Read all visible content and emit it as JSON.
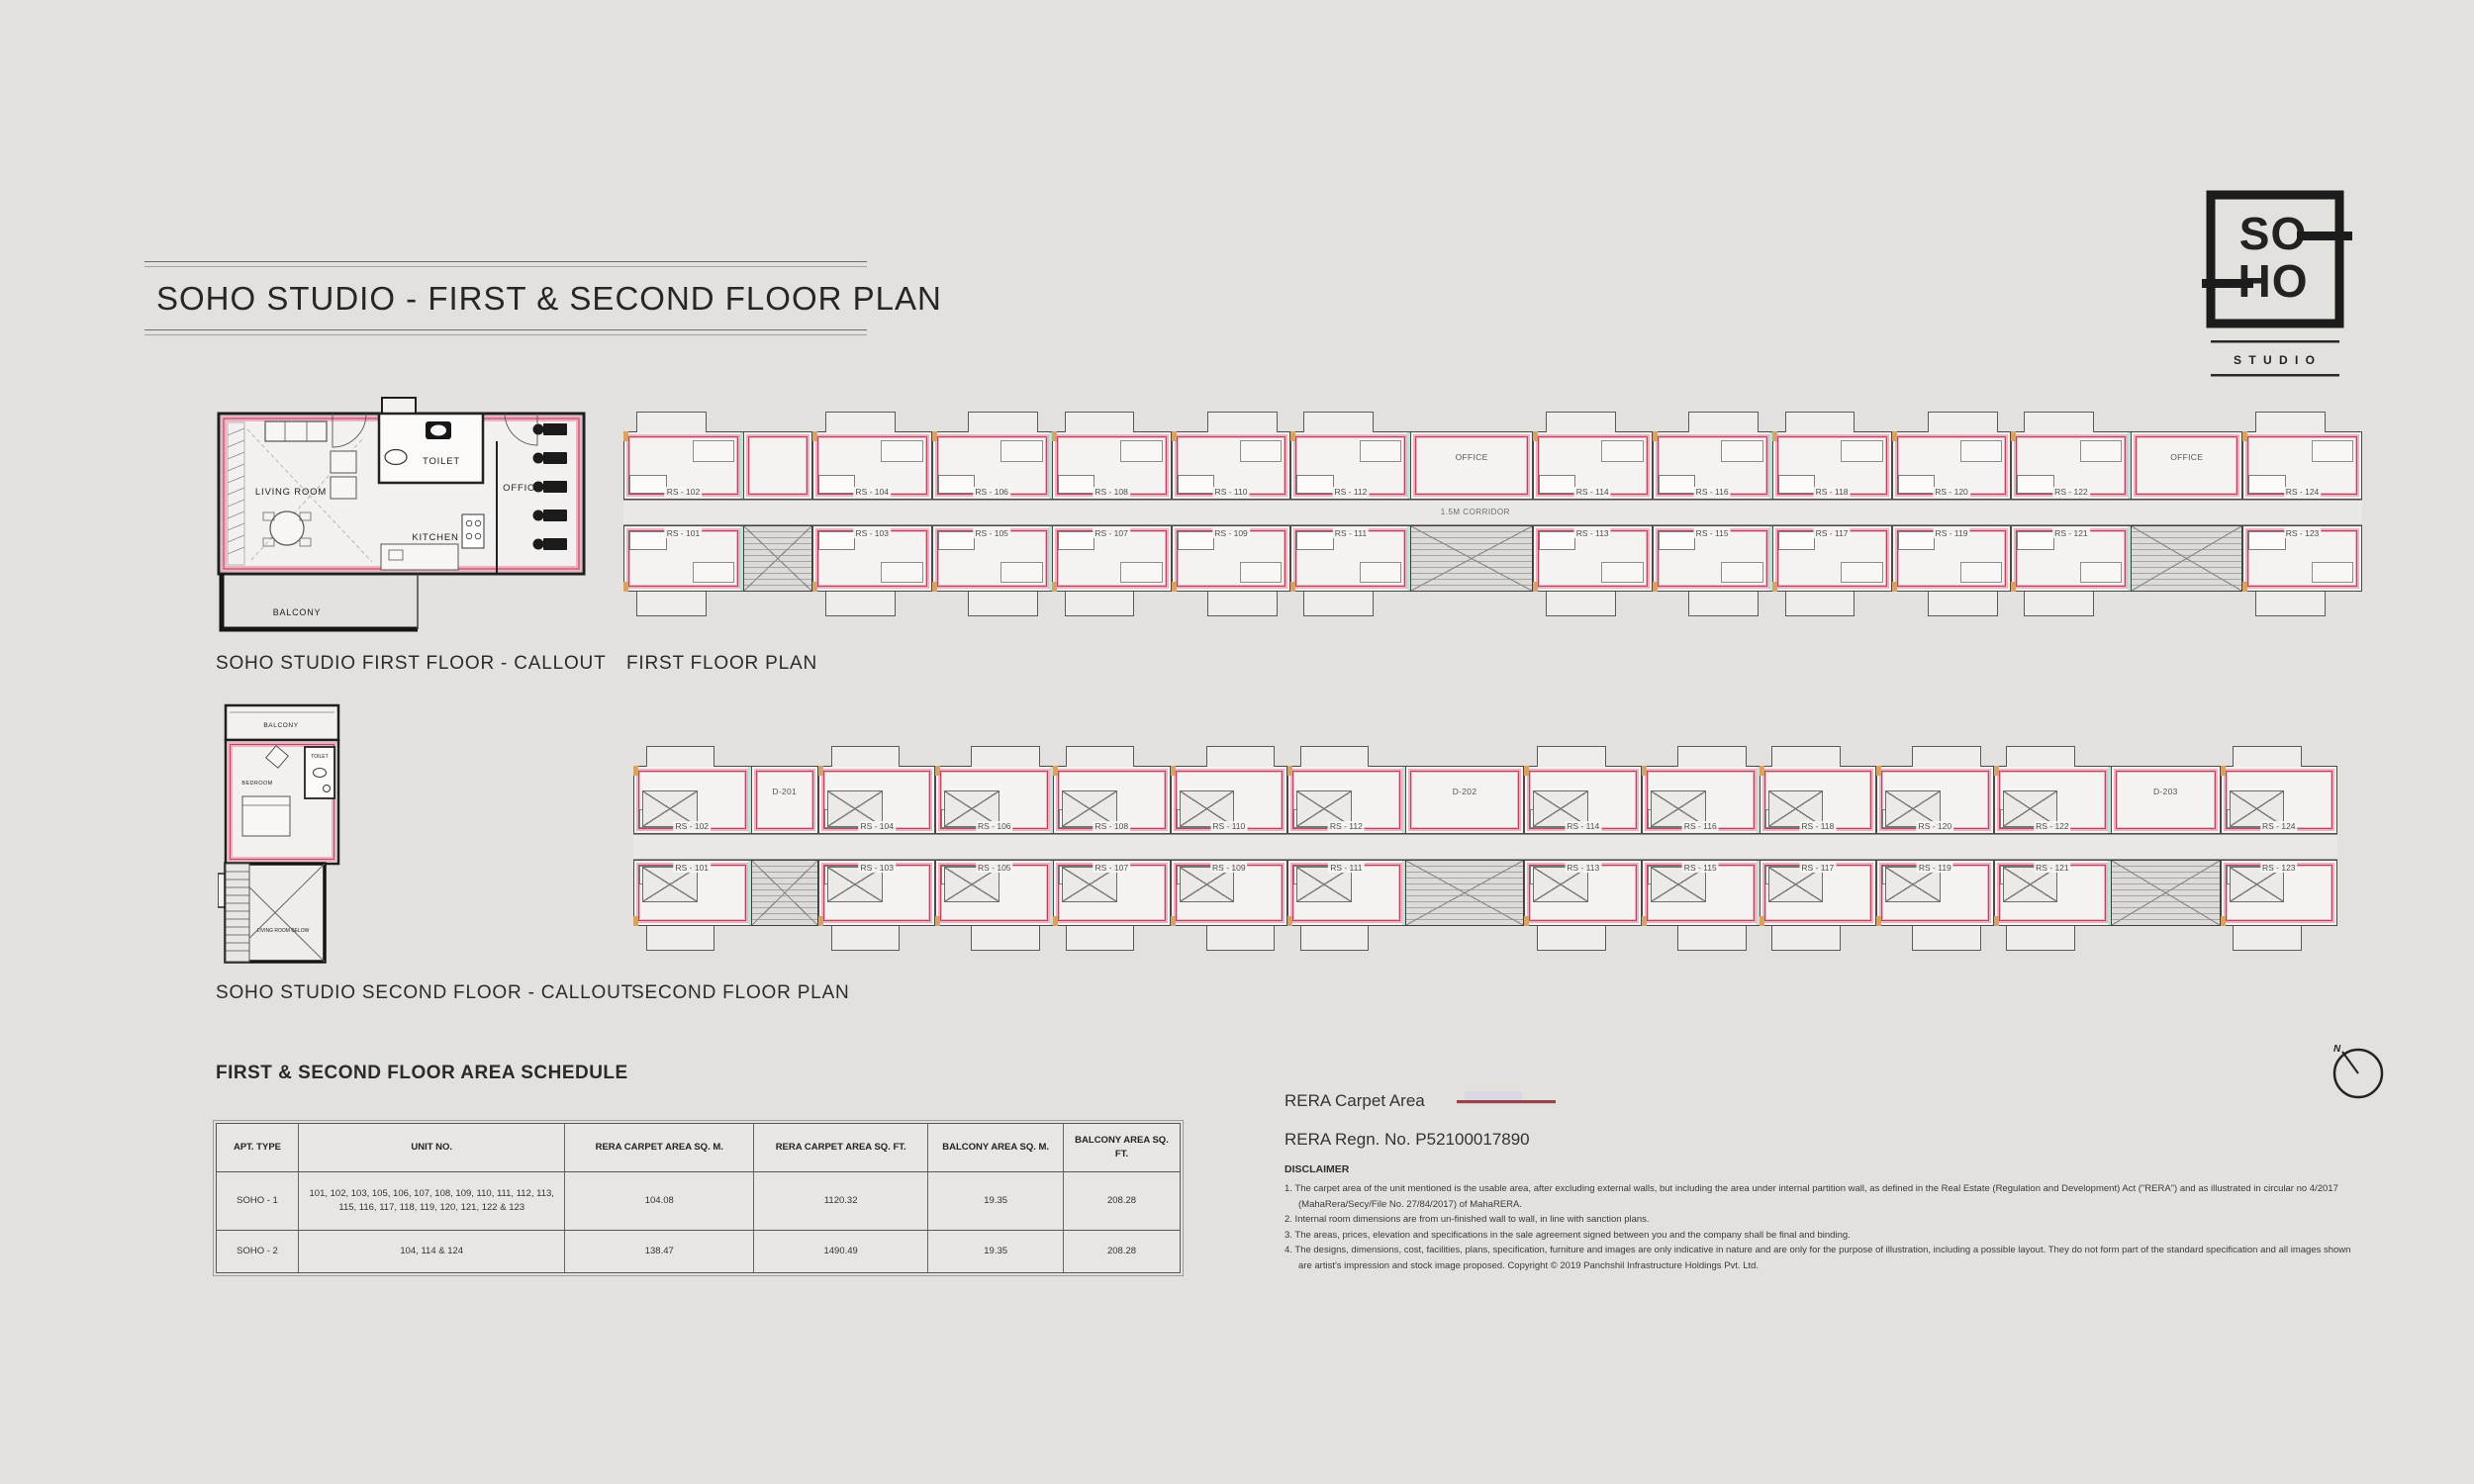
{
  "page": {
    "title": "SOHO STUDIO - FIRST & SECOND FLOOR PLAN"
  },
  "logo": {
    "so": "SO",
    "ho": "HO",
    "studio": "S T U D I O"
  },
  "colors": {
    "background": "#e3e1de",
    "wall_pink": "#efb0c2",
    "rera_carpet_line": "#b5485c",
    "legend_line": "#96464a",
    "ink": "#262626"
  },
  "callouts": {
    "first": {
      "caption": "SOHO STUDIO FIRST FLOOR - CALLOUT",
      "rooms": {
        "living": "LIVING ROOM",
        "toilet": "TOILET",
        "kitchen": "KITCHEN",
        "office": "OFFICE",
        "balcony": "BALCONY"
      }
    },
    "second": {
      "caption": "SOHO STUDIO SECOND FLOOR - CALLOUT",
      "rooms": {
        "balcony": "BALCONY",
        "bedroom": "BEDROOM",
        "toilet": "TOILET",
        "below": "LIVING ROOM BELOW"
      }
    }
  },
  "plans": {
    "first": {
      "caption": "FIRST FLOOR PLAN",
      "corridor_label": "1.5M CORRIDOR",
      "top_cells": [
        {
          "t": "u",
          "n": "RS - 102"
        },
        {
          "t": "r",
          "n": "",
          "w": 0.57
        },
        {
          "t": "u",
          "n": "RS - 104"
        },
        {
          "t": "u",
          "n": "RS - 106"
        },
        {
          "t": "u",
          "n": "RS - 108"
        },
        {
          "t": "u",
          "n": "RS - 110"
        },
        {
          "t": "u",
          "n": "RS - 112"
        },
        {
          "t": "r",
          "n": "OFFICE",
          "w": 1.02
        },
        {
          "t": "u",
          "n": "RS - 114"
        },
        {
          "t": "u",
          "n": "RS - 116"
        },
        {
          "t": "u",
          "n": "RS - 118"
        },
        {
          "t": "u",
          "n": "RS - 120"
        },
        {
          "t": "u",
          "n": "RS - 122"
        },
        {
          "t": "r",
          "n": "OFFICE",
          "w": 0.93
        },
        {
          "t": "u",
          "n": "RS - 124"
        }
      ],
      "bottom_cells": [
        {
          "t": "u",
          "n": "RS - 101"
        },
        {
          "t": "c",
          "w": 0.57
        },
        {
          "t": "u",
          "n": "RS - 103"
        },
        {
          "t": "u",
          "n": "RS - 105"
        },
        {
          "t": "u",
          "n": "RS - 107"
        },
        {
          "t": "u",
          "n": "RS - 109"
        },
        {
          "t": "u",
          "n": "RS - 111"
        },
        {
          "t": "c",
          "w": 1.02
        },
        {
          "t": "u",
          "n": "RS - 113"
        },
        {
          "t": "u",
          "n": "RS - 115"
        },
        {
          "t": "u",
          "n": "RS - 117"
        },
        {
          "t": "u",
          "n": "RS - 119"
        },
        {
          "t": "u",
          "n": "RS - 121"
        },
        {
          "t": "c",
          "w": 0.93
        },
        {
          "t": "u",
          "n": "RS - 123"
        }
      ]
    },
    "second": {
      "caption": "SECOND FLOOR PLAN",
      "corridor_label": "",
      "top_cells": [
        {
          "t": "u",
          "n": "RS - 102"
        },
        {
          "t": "r",
          "n": "D-201",
          "w": 0.57
        },
        {
          "t": "u",
          "n": "RS - 104"
        },
        {
          "t": "u",
          "n": "RS - 106"
        },
        {
          "t": "u",
          "n": "RS - 108"
        },
        {
          "t": "u",
          "n": "RS - 110"
        },
        {
          "t": "u",
          "n": "RS - 112"
        },
        {
          "t": "r",
          "n": "D-202",
          "w": 1.02
        },
        {
          "t": "u",
          "n": "RS - 114"
        },
        {
          "t": "u",
          "n": "RS - 116"
        },
        {
          "t": "u",
          "n": "RS - 118"
        },
        {
          "t": "u",
          "n": "RS - 120"
        },
        {
          "t": "u",
          "n": "RS - 122"
        },
        {
          "t": "r",
          "n": "D-203",
          "w": 0.93
        },
        {
          "t": "u",
          "n": "RS - 124"
        }
      ],
      "bottom_cells": [
        {
          "t": "u",
          "n": "RS - 101"
        },
        {
          "t": "c",
          "w": 0.57
        },
        {
          "t": "u",
          "n": "RS - 103"
        },
        {
          "t": "u",
          "n": "RS - 105"
        },
        {
          "t": "u",
          "n": "RS - 107"
        },
        {
          "t": "u",
          "n": "RS - 109"
        },
        {
          "t": "u",
          "n": "RS - 111"
        },
        {
          "t": "c",
          "w": 1.02
        },
        {
          "t": "u",
          "n": "RS - 113"
        },
        {
          "t": "u",
          "n": "RS - 115"
        },
        {
          "t": "u",
          "n": "RS - 117"
        },
        {
          "t": "u",
          "n": "RS - 119"
        },
        {
          "t": "u",
          "n": "RS - 121"
        },
        {
          "t": "c",
          "w": 0.93
        },
        {
          "t": "u",
          "n": "RS - 123"
        }
      ]
    }
  },
  "schedule": {
    "title": "FIRST & SECOND FLOOR AREA SCHEDULE",
    "columns": [
      "APT. TYPE",
      "UNIT NO.",
      "RERA CARPET AREA SQ. M.",
      "RERA CARPET AREA SQ. FT.",
      "BALCONY AREA SQ. M.",
      "BALCONY AREA SQ. FT."
    ],
    "rows": [
      {
        "apt_type": "SOHO - 1",
        "unit_no": "101, 102, 103, 105, 106, 107, 108, 109, 110, 111, 112, 113, 115, 116, 117, 118, 119, 120, 121, 122 & 123",
        "carpet_sqm": "104.08",
        "carpet_sqft": "1120.32",
        "balcony_sqm": "19.35",
        "balcony_sqft": "208.28"
      },
      {
        "apt_type": "SOHO - 2",
        "unit_no": "104, 114 & 124",
        "carpet_sqm": "138.47",
        "carpet_sqft": "1490.49",
        "balcony_sqm": "19.35",
        "balcony_sqft": "208.28"
      }
    ]
  },
  "legend": {
    "carpet_label": "RERA Carpet Area",
    "regn": "RERA Regn. No. P52100017890"
  },
  "disclaimer": {
    "heading": "DISCLAIMER",
    "items": [
      "1. The carpet area of the unit mentioned is the usable area, after excluding external walls, but including the area under internal partition wall, as defined in the Real Estate (Regulation and Development) Act (\"RERA\") and as illustrated in circular no 4/2017 (MahaRera/Secy/File No. 27/84/2017) of MahaRERA.",
      "2. Internal room dimensions are from un-finished wall to wall, in line with sanction plans.",
      "3. The areas, prices, elevation and specifications in the sale agreement signed between you and the company shall be final and binding.",
      "4. The designs, dimensions, cost, facilities, plans, specification, furniture and images are only indicative in nature and are only for the purpose of illustration, including a possible layout. They do not form part of the standard specification and all images shown are artist's impression and stock image proposed. Copyright © 2019 Panchshil Infrastructure Holdings Pvt. Ltd."
    ]
  },
  "compass": {
    "label": "N"
  }
}
